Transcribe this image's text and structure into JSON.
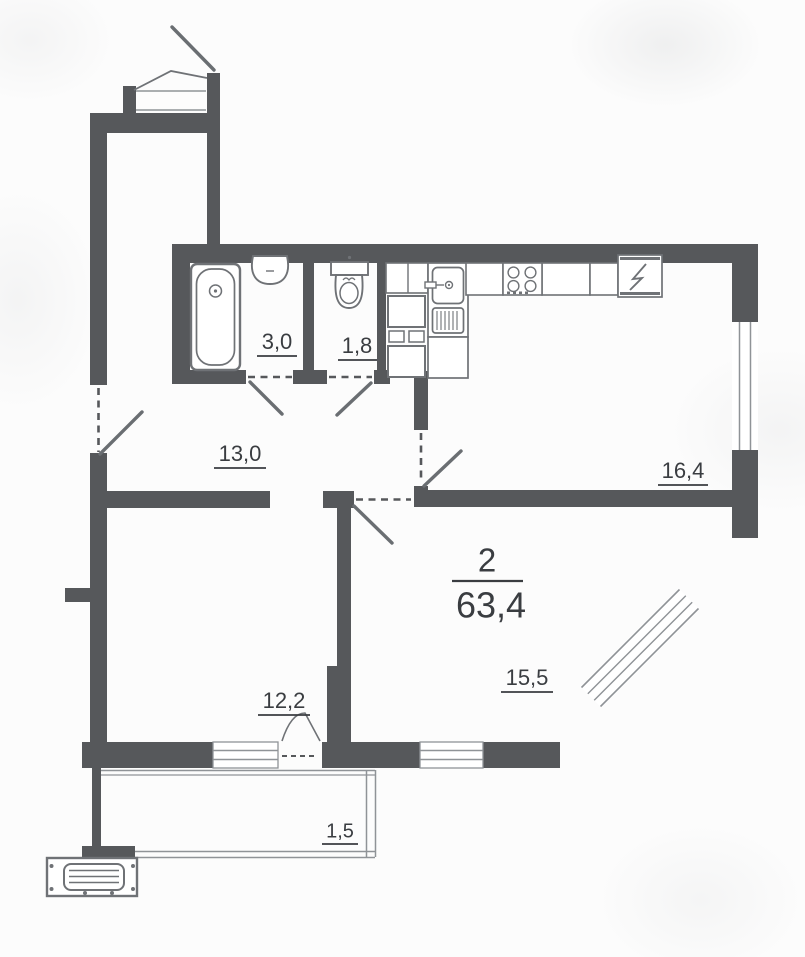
{
  "plan": {
    "title": {
      "rooms": "2",
      "area_total": "63,4"
    },
    "areas": {
      "bathroom": "3,0",
      "toilet": "1,8",
      "hallway": "13,0",
      "kitchen_living": "16,4",
      "bedroom": "12,2",
      "living_room": "15,5",
      "balcony": "1,5"
    },
    "fixtures": [
      "bathtub-icon",
      "washbasin-icon",
      "toilet-icon",
      "kitchen-sink-icon",
      "drainboard-icon",
      "stove-icon",
      "refrigerator-icon",
      "oven-stack-icon",
      "radiator-icon"
    ],
    "colors": {
      "wall": "#56585b",
      "fixture": "#6f7276",
      "thin": "#8f9397",
      "swing": "#6a6e72",
      "label": "#3a3d41",
      "background": "#fcfcfc"
    }
  }
}
